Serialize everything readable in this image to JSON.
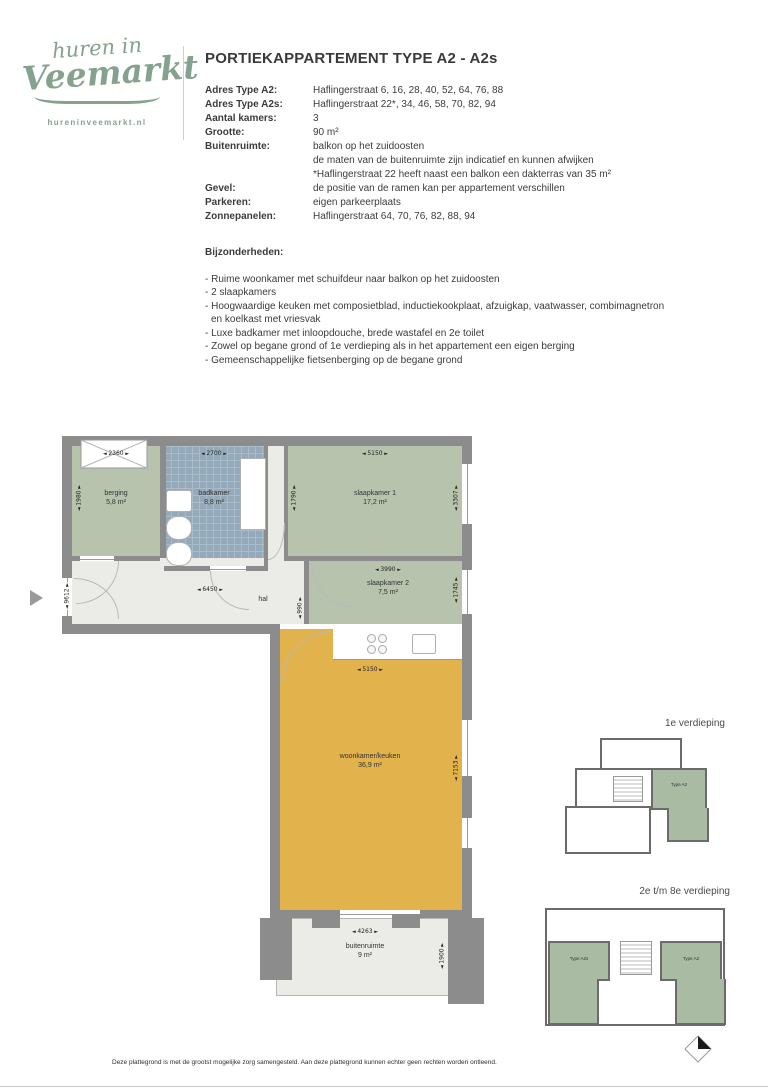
{
  "logo": {
    "line1": "huren in",
    "line2": "Veemarkt",
    "url": "hureninveemarkt.nl"
  },
  "header": {
    "title_regular": "PORTIEKAPPARTEMENT",
    "title_bold": "TYPE A2 - A2s"
  },
  "specs": [
    {
      "label": "Adres Type A2:",
      "value": "Haflingerstraat 6, 16, 28, 40, 52, 64, 76, 88"
    },
    {
      "label": "Adres Type A2s:",
      "value": "Haflingerstraat 22*, 34, 46, 58, 70, 82, 94"
    },
    {
      "label": "Aantal kamers:",
      "value": "3"
    },
    {
      "label": "Grootte:",
      "value": "90 m²"
    },
    {
      "label": "Buitenruimte:",
      "value": "balkon op het zuidoosten"
    },
    {
      "label": "",
      "value": "de maten van de buitenruimte zijn indicatief en kunnen afwijken"
    },
    {
      "label": "",
      "value": "*Haflingerstraat 22 heeft naast een balkon een dakterras van 35 m²"
    },
    {
      "label": "Gevel:",
      "value": "de positie van de ramen kan per appartement verschillen"
    },
    {
      "label": "Parkeren:",
      "value": "eigen parkeerplaats"
    },
    {
      "label": "Zonnepanelen:",
      "value": "Haflingerstraat 64, 70, 76, 82, 88, 94"
    }
  ],
  "features": {
    "heading": "Bijzonderheden:",
    "items": [
      "- Ruime woonkamer met schuifdeur naar balkon op het zuidoosten",
      "- 2 slaapkamers",
      "- Hoogwaardige keuken met composietblad, inductiekookplaat, afzuigkap, vaatwasser, combimagnetron en koelkast met vriesvak",
      "- Luxe badkamer met inloopdouche, brede wastafel en 2e toilet",
      "- Zowel op begane grond of 1e verdieping als in het appartement een eigen berging",
      "- Gemeenschappelijke fietsenberging op de begane grond"
    ]
  },
  "floorplan": {
    "rooms": {
      "berging": {
        "name": "berging",
        "area": "5,8 m²"
      },
      "badkamer": {
        "name": "badkamer",
        "area": "8,8 m²"
      },
      "slaapkamer1": {
        "name": "slaapkamer 1",
        "area": "17,2 m²"
      },
      "slaapkamer2": {
        "name": "slaapkamer 2",
        "area": "7,5 m²"
      },
      "hal": {
        "name": "hal"
      },
      "woonkamer": {
        "name": "woonkamer/keuken",
        "area": "36,9 m²"
      },
      "buitenruimte": {
        "name": "buitenruimte",
        "area": "9 m²"
      }
    },
    "dims": {
      "berging_w": "2360",
      "berging_h": "1980",
      "badkamer_w": "2700",
      "slaapkamer1_w": "5150",
      "slaapkamer1_h_left": "1790",
      "slaapkamer1_h_right": "3307",
      "slaapkamer2_w": "3990",
      "slaapkamer2_h": "1745",
      "hal_w": "6450",
      "hal_h": "990",
      "entry_h": "9612",
      "woonkamer_w": "5150",
      "woonkamer_h": "7153",
      "buitenruimte_w": "4263",
      "buitenruimte_h": "1900"
    }
  },
  "miniplans": {
    "first": {
      "title": "1e verdieping",
      "unit_right": "Type A2"
    },
    "upper": {
      "title": "2e t/m 8e verdieping",
      "unit_left": "Type A2s",
      "unit_right": "Type A2"
    }
  },
  "footer": {
    "disclaimer": "Deze plattegrond is met de grootst mogelijke zorg samengesteld. Aan deze plattegrond kunnen echter geen rechten worden ontleend."
  },
  "colors": {
    "brand_green": "#84a28e",
    "room_green": "#b7c3ad",
    "bath_blue": "#94aaba",
    "living_yellow": "#e2b24c",
    "wall_grey": "#8c8c8c",
    "floor_grey": "#ebebe8",
    "mini_green": "#a9bba2"
  }
}
